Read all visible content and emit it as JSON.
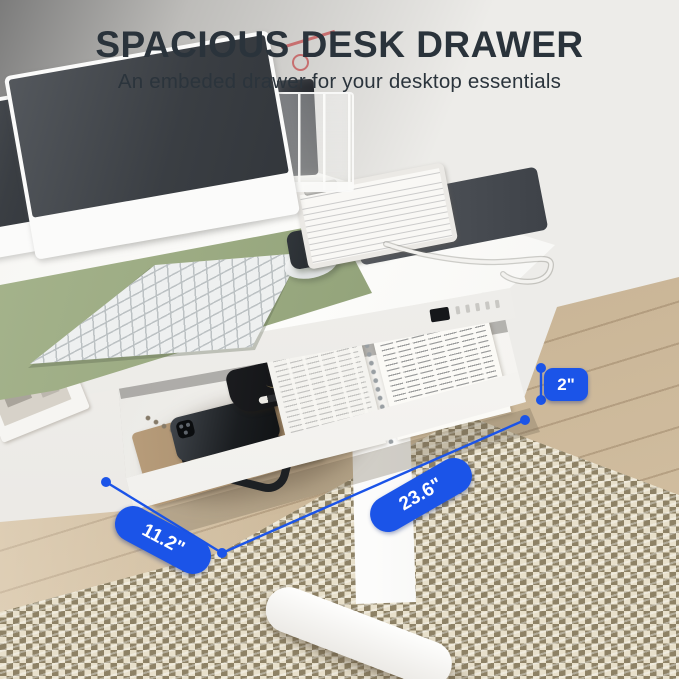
{
  "header": {
    "title": "SPACIOUS DESK DRAWER",
    "subtitle": "An embeded drawer for your desktop essentials"
  },
  "dimensions": {
    "items": [
      {
        "name": "drawer-height",
        "label": "2\""
      },
      {
        "name": "drawer-width",
        "label": "23.6\""
      },
      {
        "name": "drawer-depth",
        "label": "11.2\""
      }
    ]
  },
  "icons": {
    "charging_bolt": "⚡"
  },
  "colors": {
    "accent_blue": "#1B54E8",
    "heading_text": "#2A333B",
    "mat_green": "#9BAC81",
    "desk_white": "#FAFAF8",
    "rug_beige": "#E6DECA",
    "floor_wood": "#CDB795"
  }
}
